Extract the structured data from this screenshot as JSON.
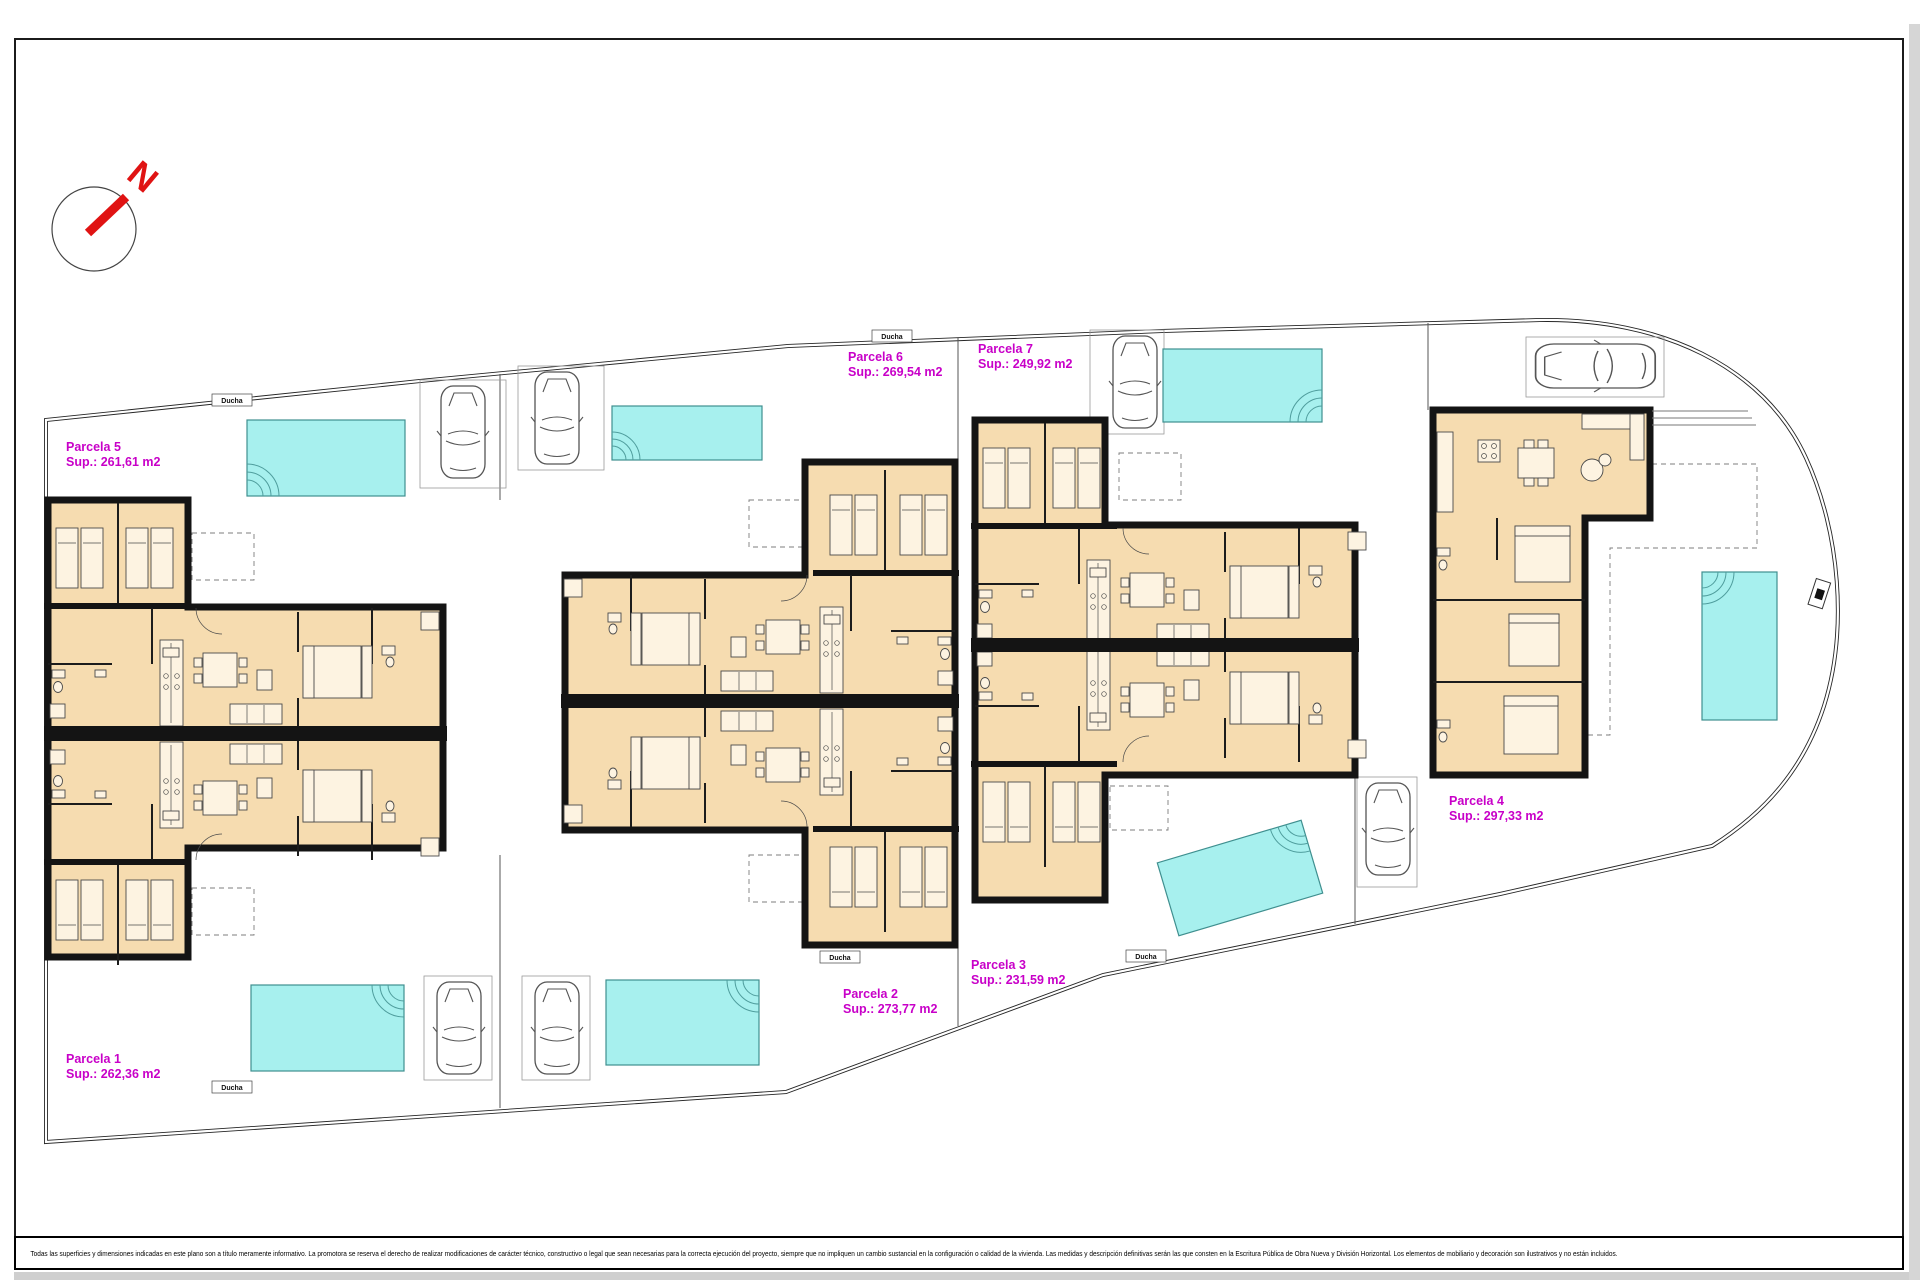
{
  "colors": {
    "room_fill": "#f6dcb0",
    "wall": "#141414",
    "pool_fill": "#a7f0ee",
    "pool_border": "#3f8f8f",
    "parcel_label": "#c800c8",
    "compass_red": "#e01313",
    "background": "#ffffff"
  },
  "compass": {
    "letter": "N"
  },
  "parcels": [
    {
      "name": "Parcela 1",
      "sup": "Sup.: 262,36 m2"
    },
    {
      "name": "Parcela 2",
      "sup": "Sup.: 273,77 m2"
    },
    {
      "name": "Parcela 3",
      "sup": "Sup.: 231,59 m2"
    },
    {
      "name": "Parcela 4",
      "sup": "Sup.: 297,33 m2"
    },
    {
      "name": "Parcela 5",
      "sup": "Sup.: 261,61 m2"
    },
    {
      "name": "Parcela 6",
      "sup": "Sup.: 269,54 m2"
    },
    {
      "name": "Parcela 7",
      "sup": "Sup.: 249,92 m2"
    }
  ],
  "labels": {
    "shower": "Ducha"
  },
  "disclaimer": "Todas las superficies y dimensiones indicadas en este plano son a título meramente informativo. La promotora se reserva el derecho de realizar modificaciones de carácter técnico, constructivo o legal que sean necesarias para la correcta ejecución del proyecto, siempre que no impliquen un cambio sustancial en la configuración o calidad de la vivienda. Las medidas y descripción definitivas serán las que consten en la Escritura Pública de Obra Nueva y División Horizontal. Los elementos de mobiliario y decoración son ilustrativos y no están incluidos."
}
